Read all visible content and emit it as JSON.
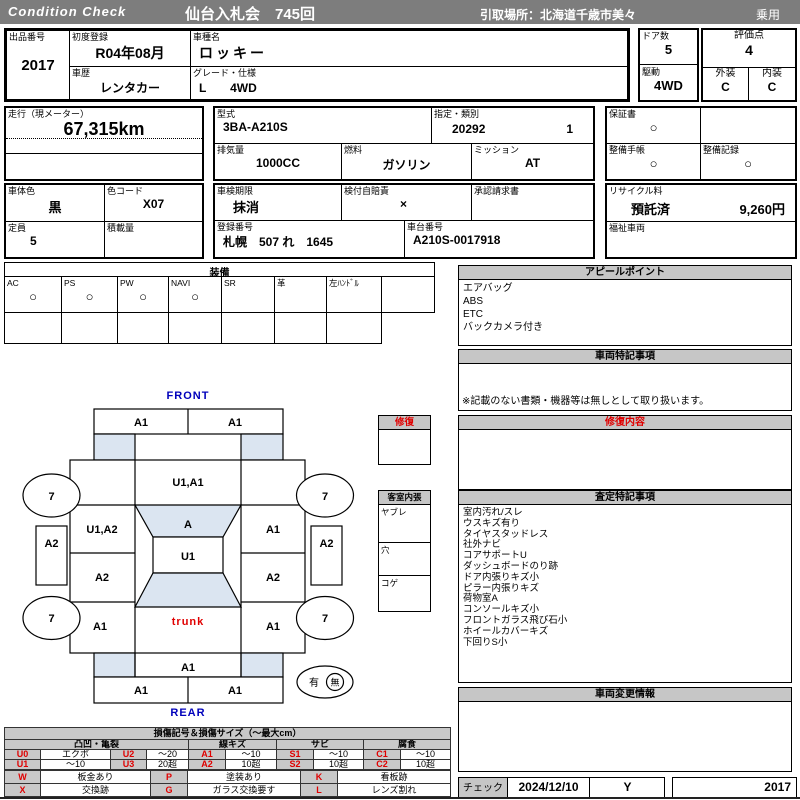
{
  "header": {
    "brand": "Condition  Check",
    "auction_title": "仙台入札会　745回",
    "pickup": "引取場所：北海道千歳市美々",
    "vehicle_class": "乗用"
  },
  "info": {
    "lot_label": "出品番号",
    "lot": "2017",
    "first_reg_label": "初度登録",
    "first_reg": "R04年08月",
    "history_label": "車歴",
    "history": "レンタカー",
    "model_label": "車種名",
    "model": "ロッキー",
    "grade_label": "グレード・仕様",
    "grade": "L　　4WD",
    "doors_label": "ドア数",
    "doors": "5",
    "drive_label": "駆動",
    "drive": "4WD",
    "score_label": "評価点",
    "score": "4",
    "exterior_label": "外装",
    "exterior": "C",
    "interior_label": "内装",
    "interior": "C",
    "mileage_label": "走行（現メーター）",
    "mileage": "67,315km",
    "type_label": "型式",
    "type": "3BA-A210S",
    "class_label": "指定・類別",
    "class_no": "20292",
    "class_sub": "1",
    "displacement_label": "排気量",
    "displacement": "1000CC",
    "fuel_label": "燃料",
    "fuel": "ガソリン",
    "transmission_label": "ミッション",
    "transmission": "AT",
    "warranty_label": "保証書",
    "warranty": "○",
    "maintenance_book_label": "整備手帳",
    "maintenance_book": "○",
    "maintenance_record_label": "整備記録",
    "maintenance_record": "○",
    "color_label": "車体色",
    "color": "黒",
    "color_code_label": "色コード",
    "color_code": "X07",
    "inspection_label": "車検期限",
    "inspection": "抹消",
    "insurance_label": "検付自賠責",
    "insurance": "×",
    "approval_label": "承認請求書",
    "recycle_label": "リサイクル料",
    "recycle_status": "預託済",
    "recycle_fee": "9,260円",
    "capacity_label": "定員",
    "capacity": "5",
    "load_label": "積載量",
    "reg_number_label": "登録番号",
    "reg_number": "札幌　507 れ　1645",
    "vin_label": "車台番号",
    "vin": "A210S-0017918",
    "welfare_label": "福祉車両"
  },
  "equipment": {
    "title": "装備",
    "items": [
      {
        "label": "AC",
        "mark": "○"
      },
      {
        "label": "PS",
        "mark": "○"
      },
      {
        "label": "PW",
        "mark": "○"
      },
      {
        "label": "NAVI",
        "mark": "○"
      },
      {
        "label": "SR",
        "mark": ""
      },
      {
        "label": "革",
        "mark": ""
      },
      {
        "label": "左ﾊﾝﾄﾞﾙ",
        "mark": ""
      },
      {
        "label": "",
        "mark": ""
      }
    ]
  },
  "appeal": {
    "title": "アピールポイント",
    "items": [
      "エアバッグ",
      "ABS",
      "ETC",
      "バックカメラ付き"
    ]
  },
  "vehicle_notes": {
    "title": "車両特記事項",
    "note": "※記載のない書類・機器等は無しとして取り扱います。"
  },
  "repair_details": {
    "title": "修復内容"
  },
  "assessment": {
    "title": "査定特記事項",
    "items": [
      "室内汚れ/スレ",
      "ウスキズ有り",
      "タイヤスタッドレス",
      "社外ナビ",
      "コアサポートU",
      "ダッシュボードのり跡",
      "ドア内張りキズ小",
      "ピラー内張りキズ",
      "荷物室A",
      "コンソールキズ小",
      "フロントガラス飛び石小",
      "ホイールカバーキズ",
      "下回りS小"
    ]
  },
  "change_info": {
    "title": "車両変更情報"
  },
  "check": {
    "label": "チェック",
    "date": "2024/12/10",
    "inspector": "Y",
    "number": "2017"
  },
  "diagram": {
    "front_label": "FRONT",
    "rear_label": "REAR",
    "trunk_label": "trunk",
    "tire_mark": "7",
    "repair_box_title": "修復",
    "cabin_box": {
      "title": "客室内張",
      "rows": [
        "ヤブレ",
        "穴",
        "コゲ"
      ]
    },
    "presence": {
      "yes": "有",
      "no": "無"
    },
    "marks": {
      "front_bumper_left": "A1",
      "front_bumper_right": "A1",
      "hood": "U1,A1",
      "windshield": "A",
      "roof": "U1",
      "left_front_fender": "U1,A2",
      "left_center": "A2",
      "left_rear_fender": "A1",
      "left_side": "A2",
      "right_side": "A2",
      "right_front_fender": "A1",
      "right_center": "A2",
      "right_rear_fender": "A1",
      "rear_gate": "A1",
      "rear_bumper_left": "A1",
      "rear_bumper_right": "A1"
    }
  },
  "legend": {
    "title": "損傷記号＆損傷サイズ（～最大cm）",
    "groups": [
      "凸凹・亀裂",
      "線キズ",
      "サビ",
      "腐食"
    ],
    "rows": [
      [
        "U0",
        "エクボ",
        "U2",
        "～20",
        "A1",
        "～10",
        "S1",
        "～10",
        "C1",
        "～10"
      ],
      [
        "U1",
        "～10",
        "U3",
        "20超",
        "A2",
        "10超",
        "S2",
        "10超",
        "C2",
        "10超"
      ]
    ],
    "rows2": [
      [
        "W",
        "板金あり",
        "P",
        "塗装あり",
        "K",
        "看板跡"
      ],
      [
        "X",
        "交換跡",
        "G",
        "ガラス交換要す",
        "L",
        "レンズ割れ"
      ]
    ]
  }
}
